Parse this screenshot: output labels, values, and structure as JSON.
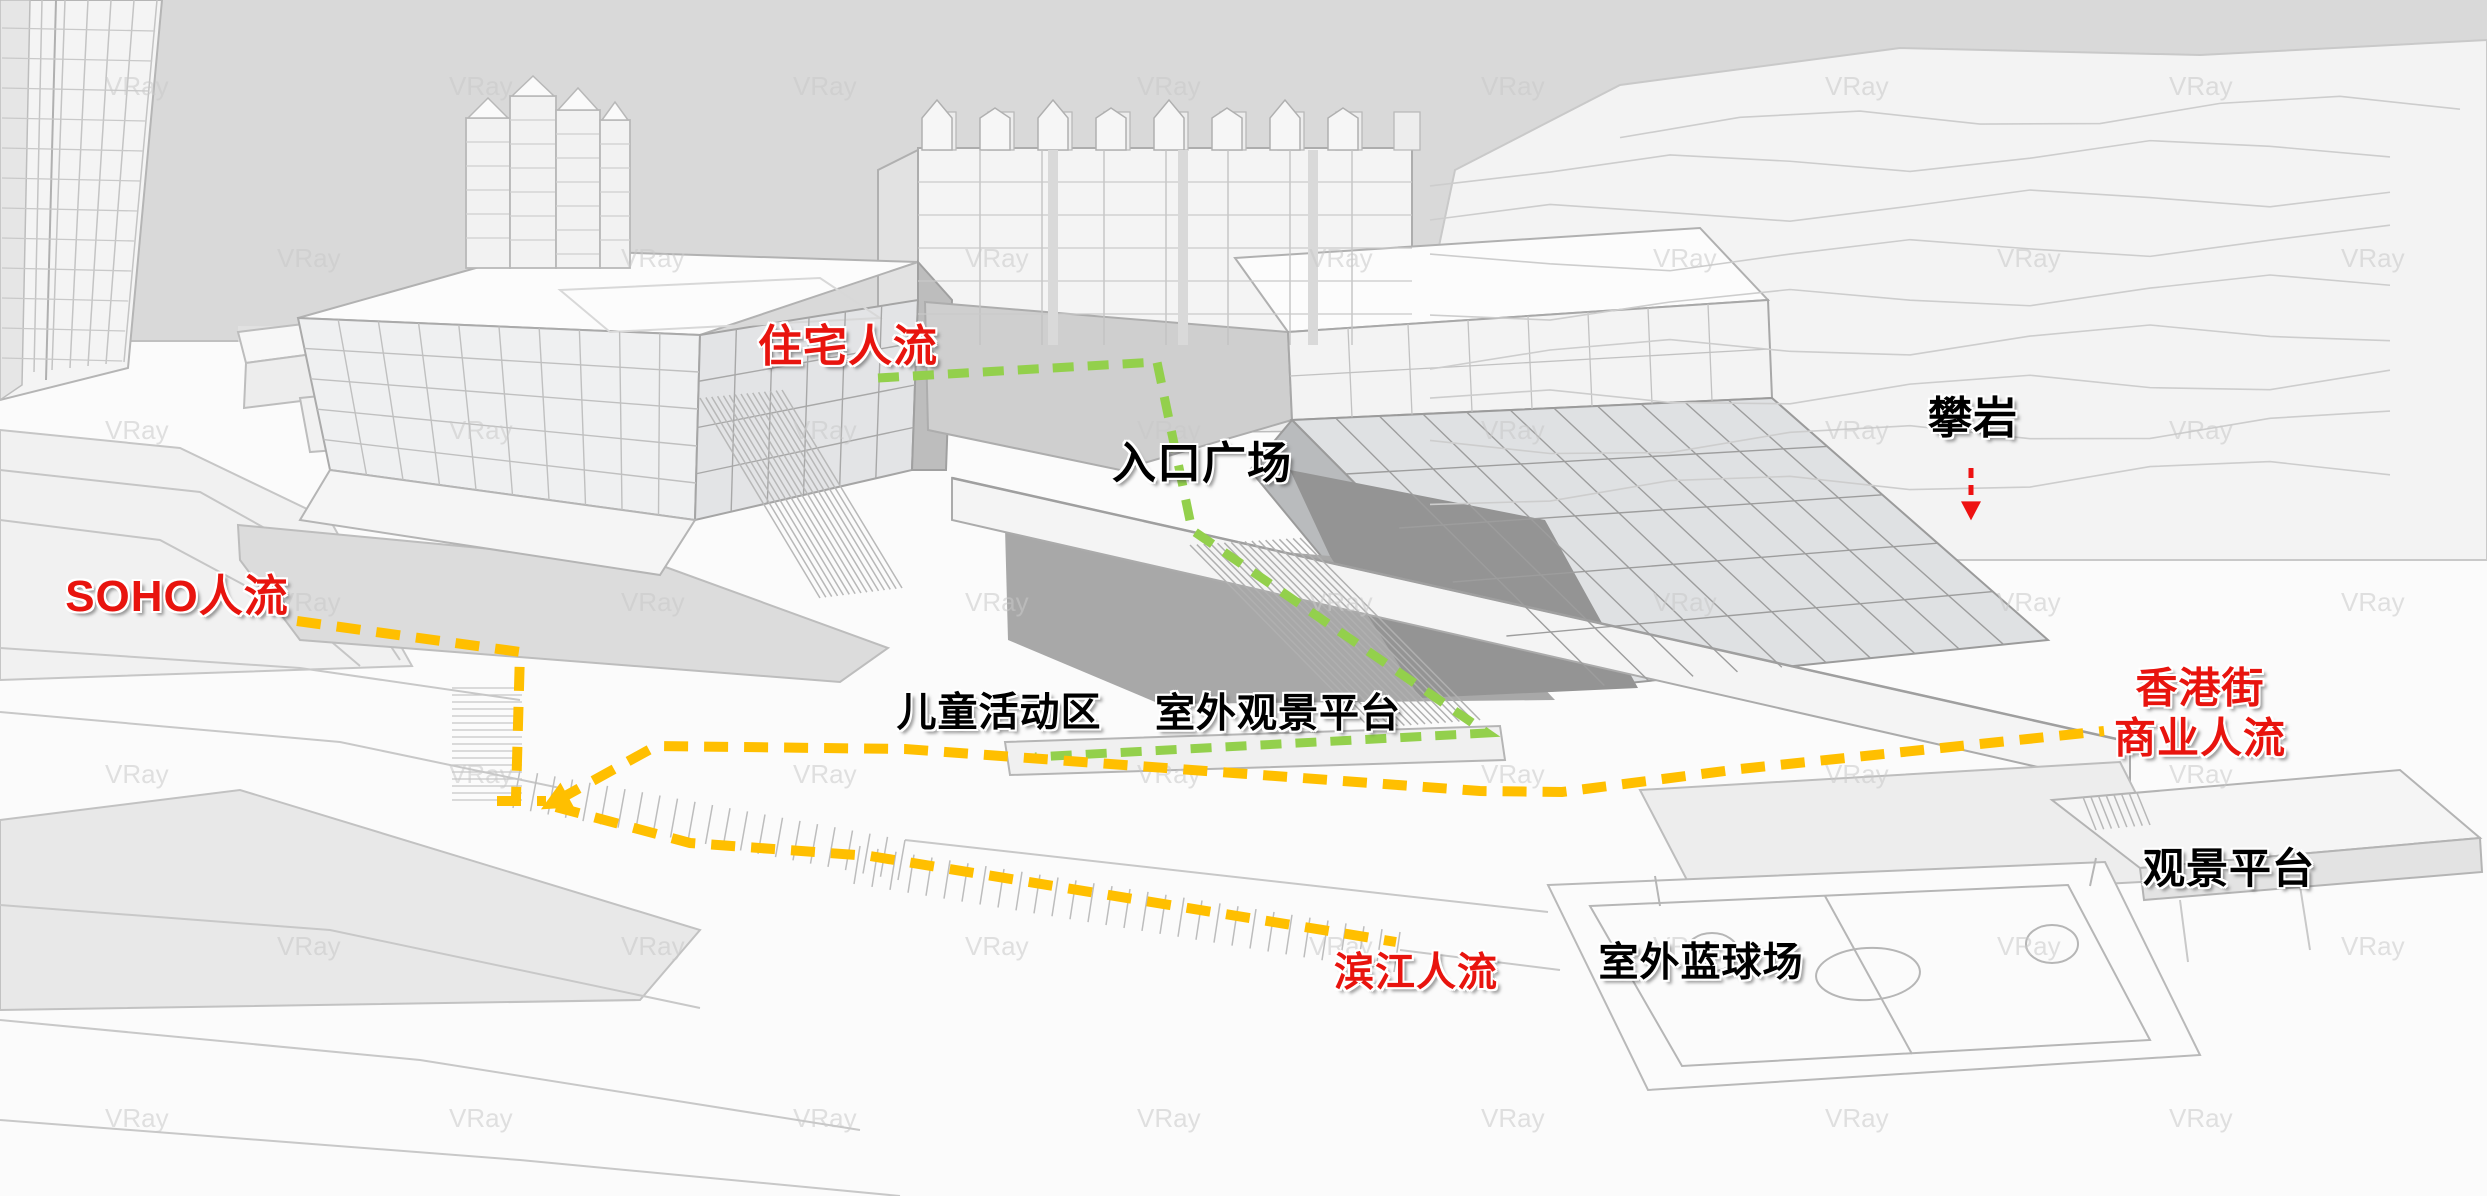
{
  "watermark": {
    "text": "VRay"
  },
  "colors": {
    "flow_green": "#93d04c",
    "flow_orange": "#ffbf00",
    "arrow_red": "#ee1111",
    "label_red": "#e8140e",
    "label_black": "#000000",
    "sky": "#d9d9d9"
  },
  "labels": {
    "residential": {
      "text": "住宅人流",
      "color": "#e8140e",
      "x": 848,
      "y": 347,
      "size": 44
    },
    "entrance_plaza": {
      "text": "入口广场",
      "color": "#000000",
      "x": 1202,
      "y": 464,
      "size": 44
    },
    "climbing": {
      "text": "攀岩",
      "color": "#000000",
      "x": 1973,
      "y": 419,
      "size": 44
    },
    "soho": {
      "text": "SOHO人流",
      "color": "#e8140e",
      "x": 177,
      "y": 597,
      "size": 44
    },
    "children_area": {
      "text": "儿童活动区",
      "color": "#000000",
      "x": 999,
      "y": 713,
      "size": 40
    },
    "outdoor_platform": {
      "text": "室外观景平台",
      "color": "#000000",
      "x": 1278,
      "y": 714,
      "size": 40
    },
    "hk_commercial": {
      "text": "香港街\n商业人流",
      "color": "#e8140e",
      "x": 2200,
      "y": 713,
      "size": 42
    },
    "viewing_platform": {
      "text": "观景平台",
      "color": "#000000",
      "x": 2229,
      "y": 869,
      "size": 42
    },
    "riverside": {
      "text": "滨江人流",
      "color": "#e8140e",
      "x": 1416,
      "y": 973,
      "size": 40
    },
    "basketball": {
      "text": "室外蓝球场",
      "color": "#000000",
      "x": 1701,
      "y": 963,
      "size": 40
    }
  },
  "flows": [
    {
      "name": "residential-flow-line",
      "color": "#93d04c",
      "width": 9,
      "dash": "21 14",
      "points": [
        [
          878,
          378
        ],
        [
          1157,
          362
        ],
        [
          1192,
          530
        ],
        [
          1487,
          733
        ],
        [
          1035,
          757
        ]
      ]
    },
    {
      "name": "soho-flow-line",
      "color": "#ffbf00",
      "width": 10,
      "dash": "24 16",
      "points": [
        [
          297,
          621
        ],
        [
          520,
          652
        ],
        [
          516,
          797
        ]
      ]
    },
    {
      "name": "soho-flow-base",
      "color": "#ffbf00",
      "width": 10,
      "dash": "24 16",
      "points": [
        [
          497,
          801
        ],
        [
          546,
          801
        ]
      ]
    },
    {
      "name": "commercial-flow-line",
      "color": "#ffbf00",
      "width": 10,
      "dash": "24 16",
      "arrow": "start",
      "points": [
        [
          558,
          800
        ],
        [
          656,
          746
        ],
        [
          905,
          749
        ],
        [
          1480,
          791
        ],
        [
          1562,
          792
        ],
        [
          1740,
          769
        ],
        [
          2104,
          731
        ]
      ]
    },
    {
      "name": "riverside-flow-line",
      "color": "#ffbf00",
      "width": 10,
      "dash": "24 16",
      "points": [
        [
          556,
          807
        ],
        [
          690,
          843
        ],
        [
          870,
          856
        ],
        [
          1396,
          942
        ]
      ]
    },
    {
      "name": "climbing-arrow",
      "color": "#ee1111",
      "width": 5,
      "dash": "10 7",
      "arrow": "end",
      "points": [
        [
          1971,
          468
        ],
        [
          1971,
          508
        ]
      ]
    }
  ]
}
